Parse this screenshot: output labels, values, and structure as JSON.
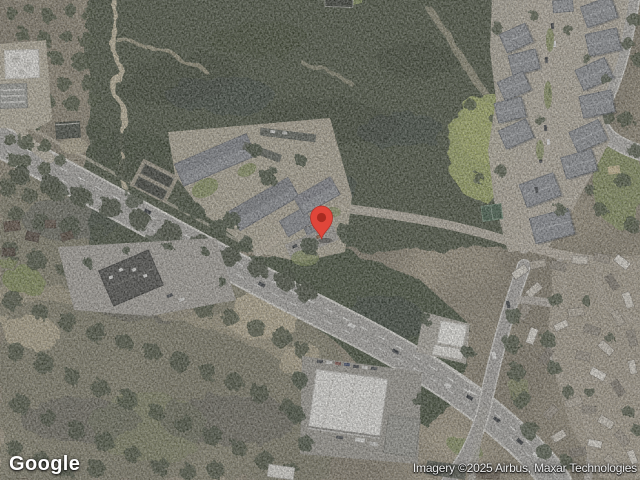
{
  "map": {
    "view_type": "satellite",
    "watermark": {
      "logo_text": "Google"
    },
    "attribution": {
      "text": "Imagery ©2025 Airbus, Maxar Technologies"
    },
    "marker": {
      "name": "red-location-pin",
      "fill": "#E0463A",
      "inner": "#A82B21",
      "outline": "#B2322A"
    },
    "palette": {
      "ground_tan": "#b5aa91",
      "forest": "#46503a",
      "forest_dark": "#39422f",
      "scrub": "#6e705a",
      "road_asphalt": "#a9a7a2",
      "road_casing": "#dcdad3",
      "grass_field": "#97a25e",
      "roof_gray": "#8d9094",
      "roof_white": "#eae9e4",
      "roof_dark": "#4b4b47"
    }
  }
}
